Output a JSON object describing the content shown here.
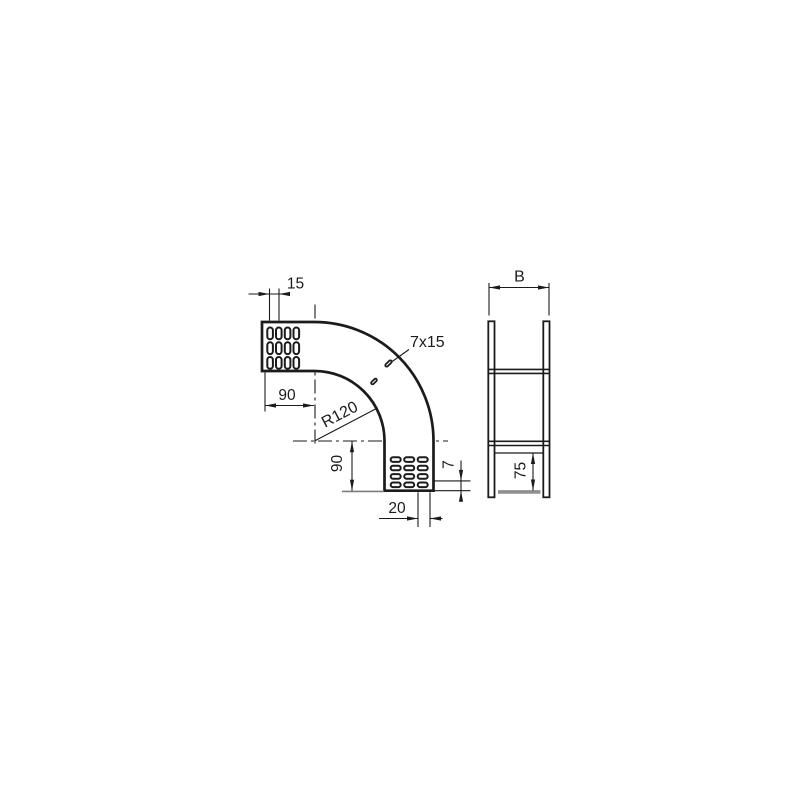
{
  "figure": {
    "background": "#ffffff",
    "line_color": "#1b1b1b",
    "bottom_plate_gray": "#8f8f8f",
    "bend_view": {
      "dim_slot_pitch": "15",
      "dim_horizontal_end_length": "90",
      "dim_bend_radius": "R120",
      "dim_slot_size": "7x15",
      "dim_vertical_end_length": "90",
      "dim_bottom_slot_width": "20",
      "dim_flange_height": "7",
      "top_end_perforation": {
        "rows": 3,
        "cols": 4
      },
      "bottom_end_perforation": {
        "rows": 4,
        "cols": 3
      },
      "curve_slot_count": 2
    },
    "section_view": {
      "dim_width_label": "B",
      "dim_side_height": "75"
    }
  }
}
